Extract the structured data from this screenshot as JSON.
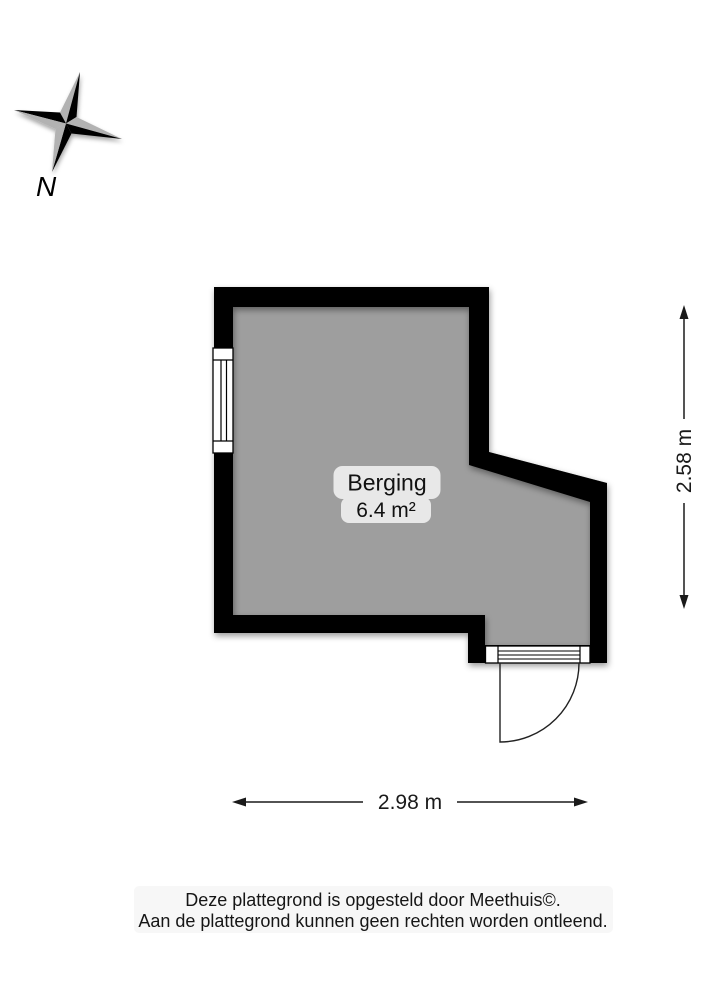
{
  "compass": {
    "icon": "compass-rose",
    "label": "N"
  },
  "room": {
    "name": "Berging",
    "area": "6.4 m²"
  },
  "dimensions": {
    "height_label": "2.58 m",
    "width_label": "2.98 m"
  },
  "footer": {
    "line1": "Deze plattegrond is opgesteld door Meethuis©.",
    "line2": "Aan de plattegrond kunnen geen rechten worden ontleend."
  },
  "colors": {
    "floor": "#9e9e9e",
    "wall": "#000000",
    "badge_bg": "#e8e8e8",
    "compass_gray": "#b2b2b2",
    "footer_bg": "#f7f7f7",
    "dimension_line": "#1a1a1a"
  }
}
